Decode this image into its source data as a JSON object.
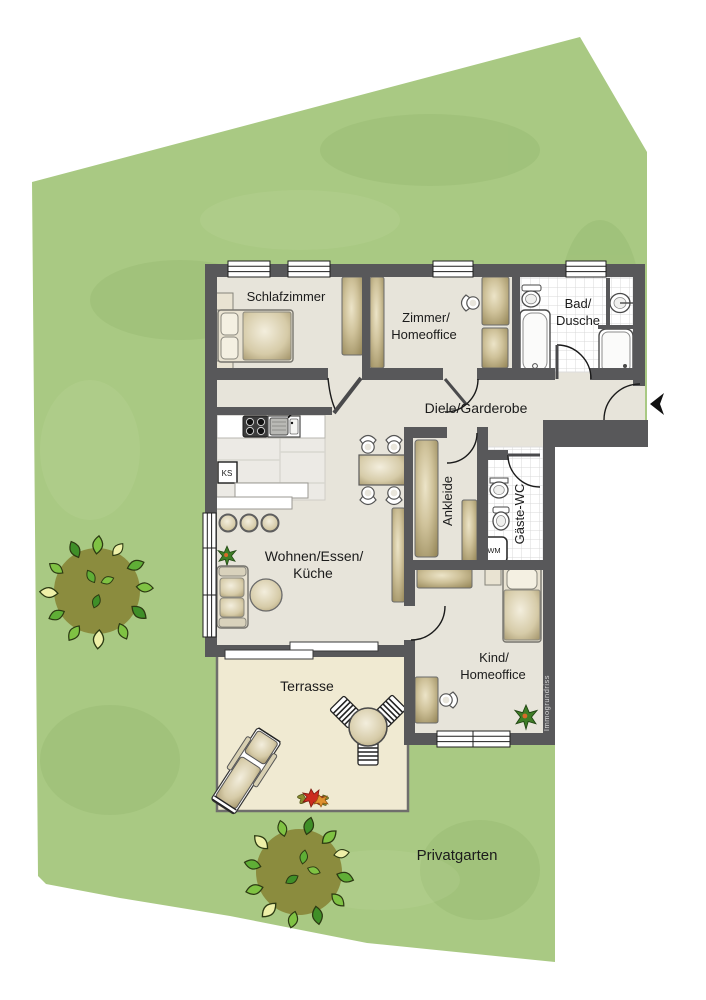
{
  "plan": {
    "watermark": "Immogrundriss",
    "rooms": {
      "schlafzimmer": {
        "label": "Schlafzimmer"
      },
      "zimmer": {
        "line1": "Zimmer/",
        "line2": "Homeoffice"
      },
      "bad": {
        "line1": "Bad/",
        "line2": "Dusche"
      },
      "diele": {
        "label": "Diele/Garderobe"
      },
      "ankleide": {
        "label": "Ankleide"
      },
      "gaeste_wc": {
        "label": "Gäste-WC"
      },
      "wohnen": {
        "line1": "Wohnen/Essen/",
        "line2": "Küche"
      },
      "kind": {
        "line1": "Kind/",
        "line2": "Homeoffice"
      },
      "terrasse": {
        "label": "Terrasse"
      },
      "garten": {
        "label": "Privatgarten"
      }
    },
    "appliances": {
      "fridge": "KS",
      "washer": "WM"
    },
    "colors": {
      "garden": "#a9c983",
      "wall": "#58585a",
      "floor": "#e7e4da",
      "terrace": "#f0ead2",
      "furniture_tan": "#c9bc93",
      "tree_crown": "#8b8c3e"
    }
  }
}
